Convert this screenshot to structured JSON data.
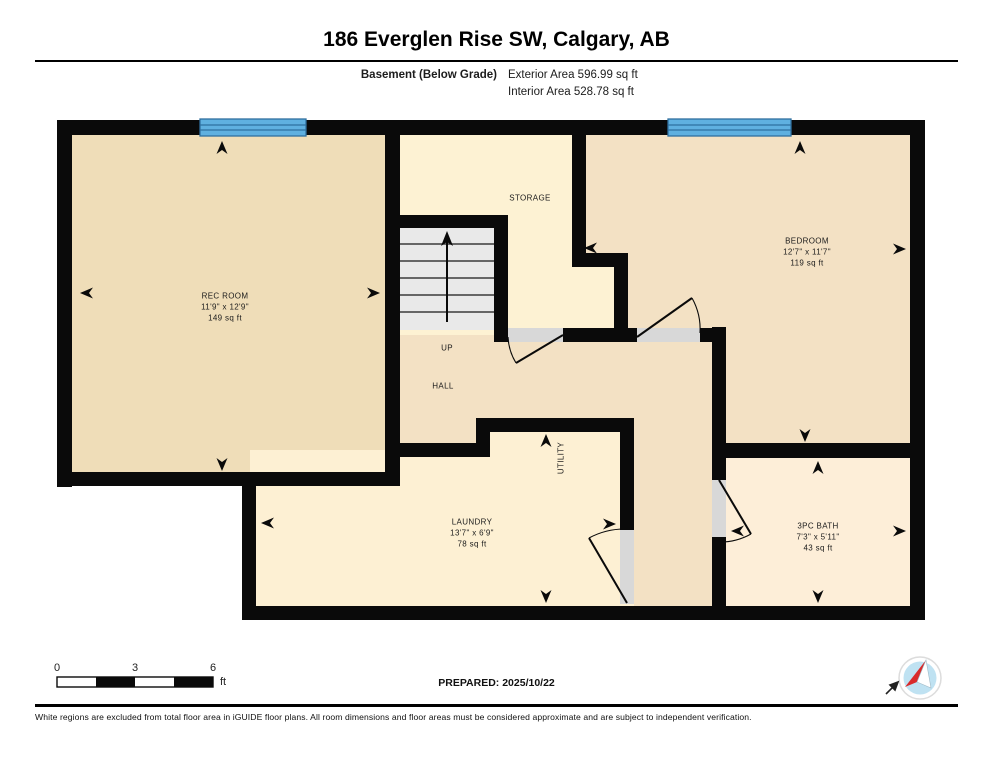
{
  "header": {
    "title": "186 Everglen Rise SW, Calgary, AB",
    "floor_label": "Basement (Below Grade)",
    "exterior_area": "Exterior Area 596.99 sq ft",
    "interior_area": "Interior Area 528.78 sq ft"
  },
  "rooms": {
    "rec_room": {
      "name": "REC ROOM",
      "dims": "11'9\" x 12'9\"",
      "area": "149 sq ft"
    },
    "storage": {
      "name": "STORAGE"
    },
    "bedroom": {
      "name": "BEDROOM",
      "dims": "12'7\" x 11'7\"",
      "area": "119 sq ft"
    },
    "hall": {
      "name": "HALL"
    },
    "stairs": {
      "name": "UP"
    },
    "utility": {
      "name": "UTILITY"
    },
    "laundry": {
      "name": "LAUNDRY",
      "dims": "13'7\" x 6'9\"",
      "area": "78 sq ft"
    },
    "bath": {
      "name": "3PC BATH",
      "dims": "7'3\" x 5'11\"",
      "area": "43 sq ft"
    }
  },
  "scale_bar": {
    "start": "0",
    "mid": "3",
    "end": "6",
    "unit": "ft"
  },
  "footer": {
    "prepared": "PREPARED: 2025/10/22",
    "disclaimer": "White regions are excluded from total floor area in iGUIDE floor plans. All room dimensions and floor areas must be considered approximate and are subject to independent verification."
  },
  "colors": {
    "wall": "#0a0a0a",
    "window_blue": "#5fb0e0",
    "window_line": "#2f6f9f",
    "floor_rec": "#efddb8",
    "floor_storage": "#fdf2d3",
    "floor_bedroom_hall": "#f3e1c4",
    "floor_laundry": "#fdf0d3",
    "floor_bath": "#fdeed8",
    "stairs_gray": "#e9e9e9",
    "door_gap_gray": "#d8d8d8",
    "compass_blue": "#bfe2f2",
    "compass_red": "#d92b2b"
  }
}
